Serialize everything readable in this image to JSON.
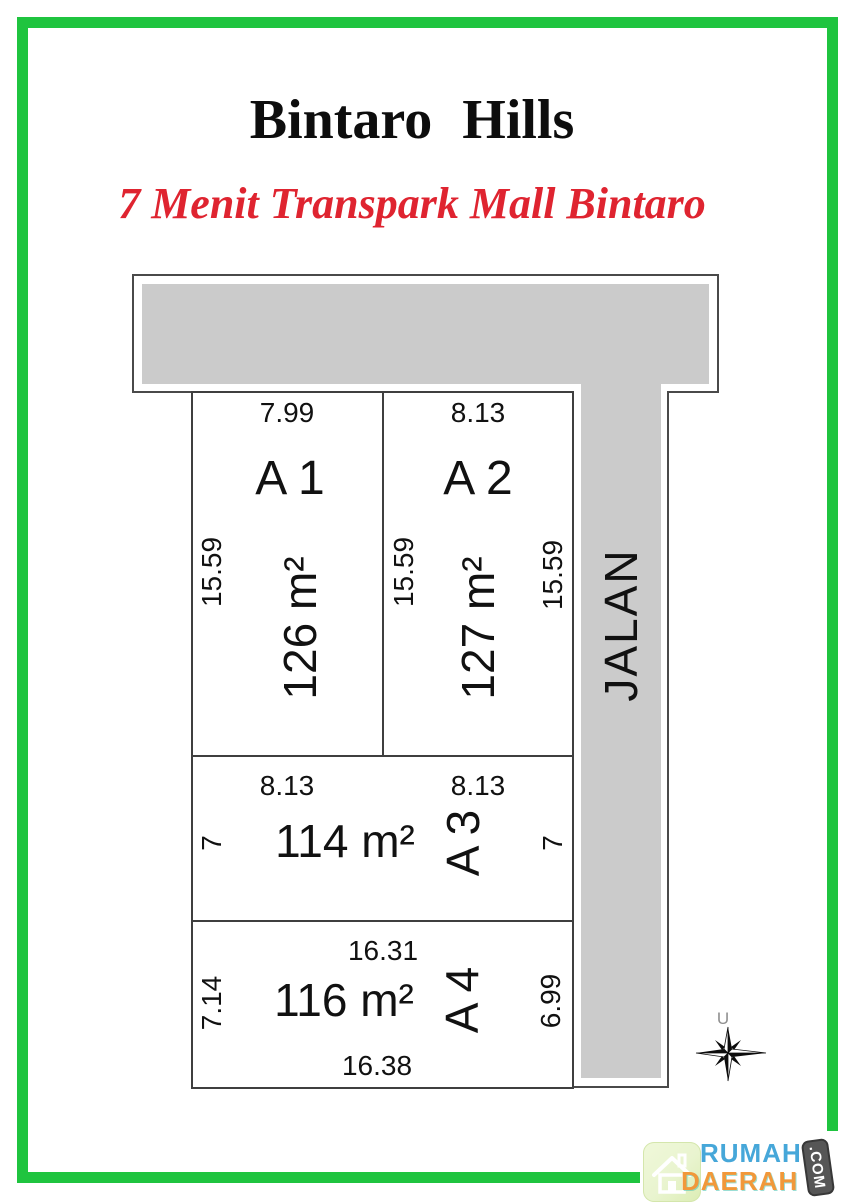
{
  "header": {
    "title": "Bintaro Hills",
    "subtitle": "7 Menit Transpark Mall Bintaro"
  },
  "road": {
    "label": "JALAN"
  },
  "plots": [
    {
      "name": "A1",
      "label": "A 1",
      "top_dim": "7.99",
      "left_dim": "15.59",
      "area": "126 m²"
    },
    {
      "name": "A2",
      "label": "A 2",
      "top_dim": "8.13",
      "left_dim": "15.59",
      "right_dim": "15.59",
      "area": "127 m²"
    },
    {
      "name": "A3",
      "label": "A 3",
      "top_dim_left": "8.13",
      "top_dim_right": "8.13",
      "left_dim": "7",
      "right_dim": "7",
      "area": "114 m²"
    },
    {
      "name": "A4",
      "label": "A 4",
      "top_dim": "16.31",
      "left_dim": "7.14",
      "right_dim": "6.99",
      "area": "116 m²",
      "bottom_dim": "16.38"
    }
  ],
  "compass": {
    "north_label": "U"
  },
  "logo": {
    "word1": "RUMAH",
    "word2": "DAERAH",
    "badge": ".COM"
  },
  "colors": {
    "frame_green": "#1fc43f",
    "road_gray": "#cbcbcb",
    "accent_red": "#df2430",
    "logo_blue": "#46a7d9",
    "logo_orange": "#f1983a",
    "badge_gray": "#565656",
    "tile_green": "#e9f4cf"
  }
}
